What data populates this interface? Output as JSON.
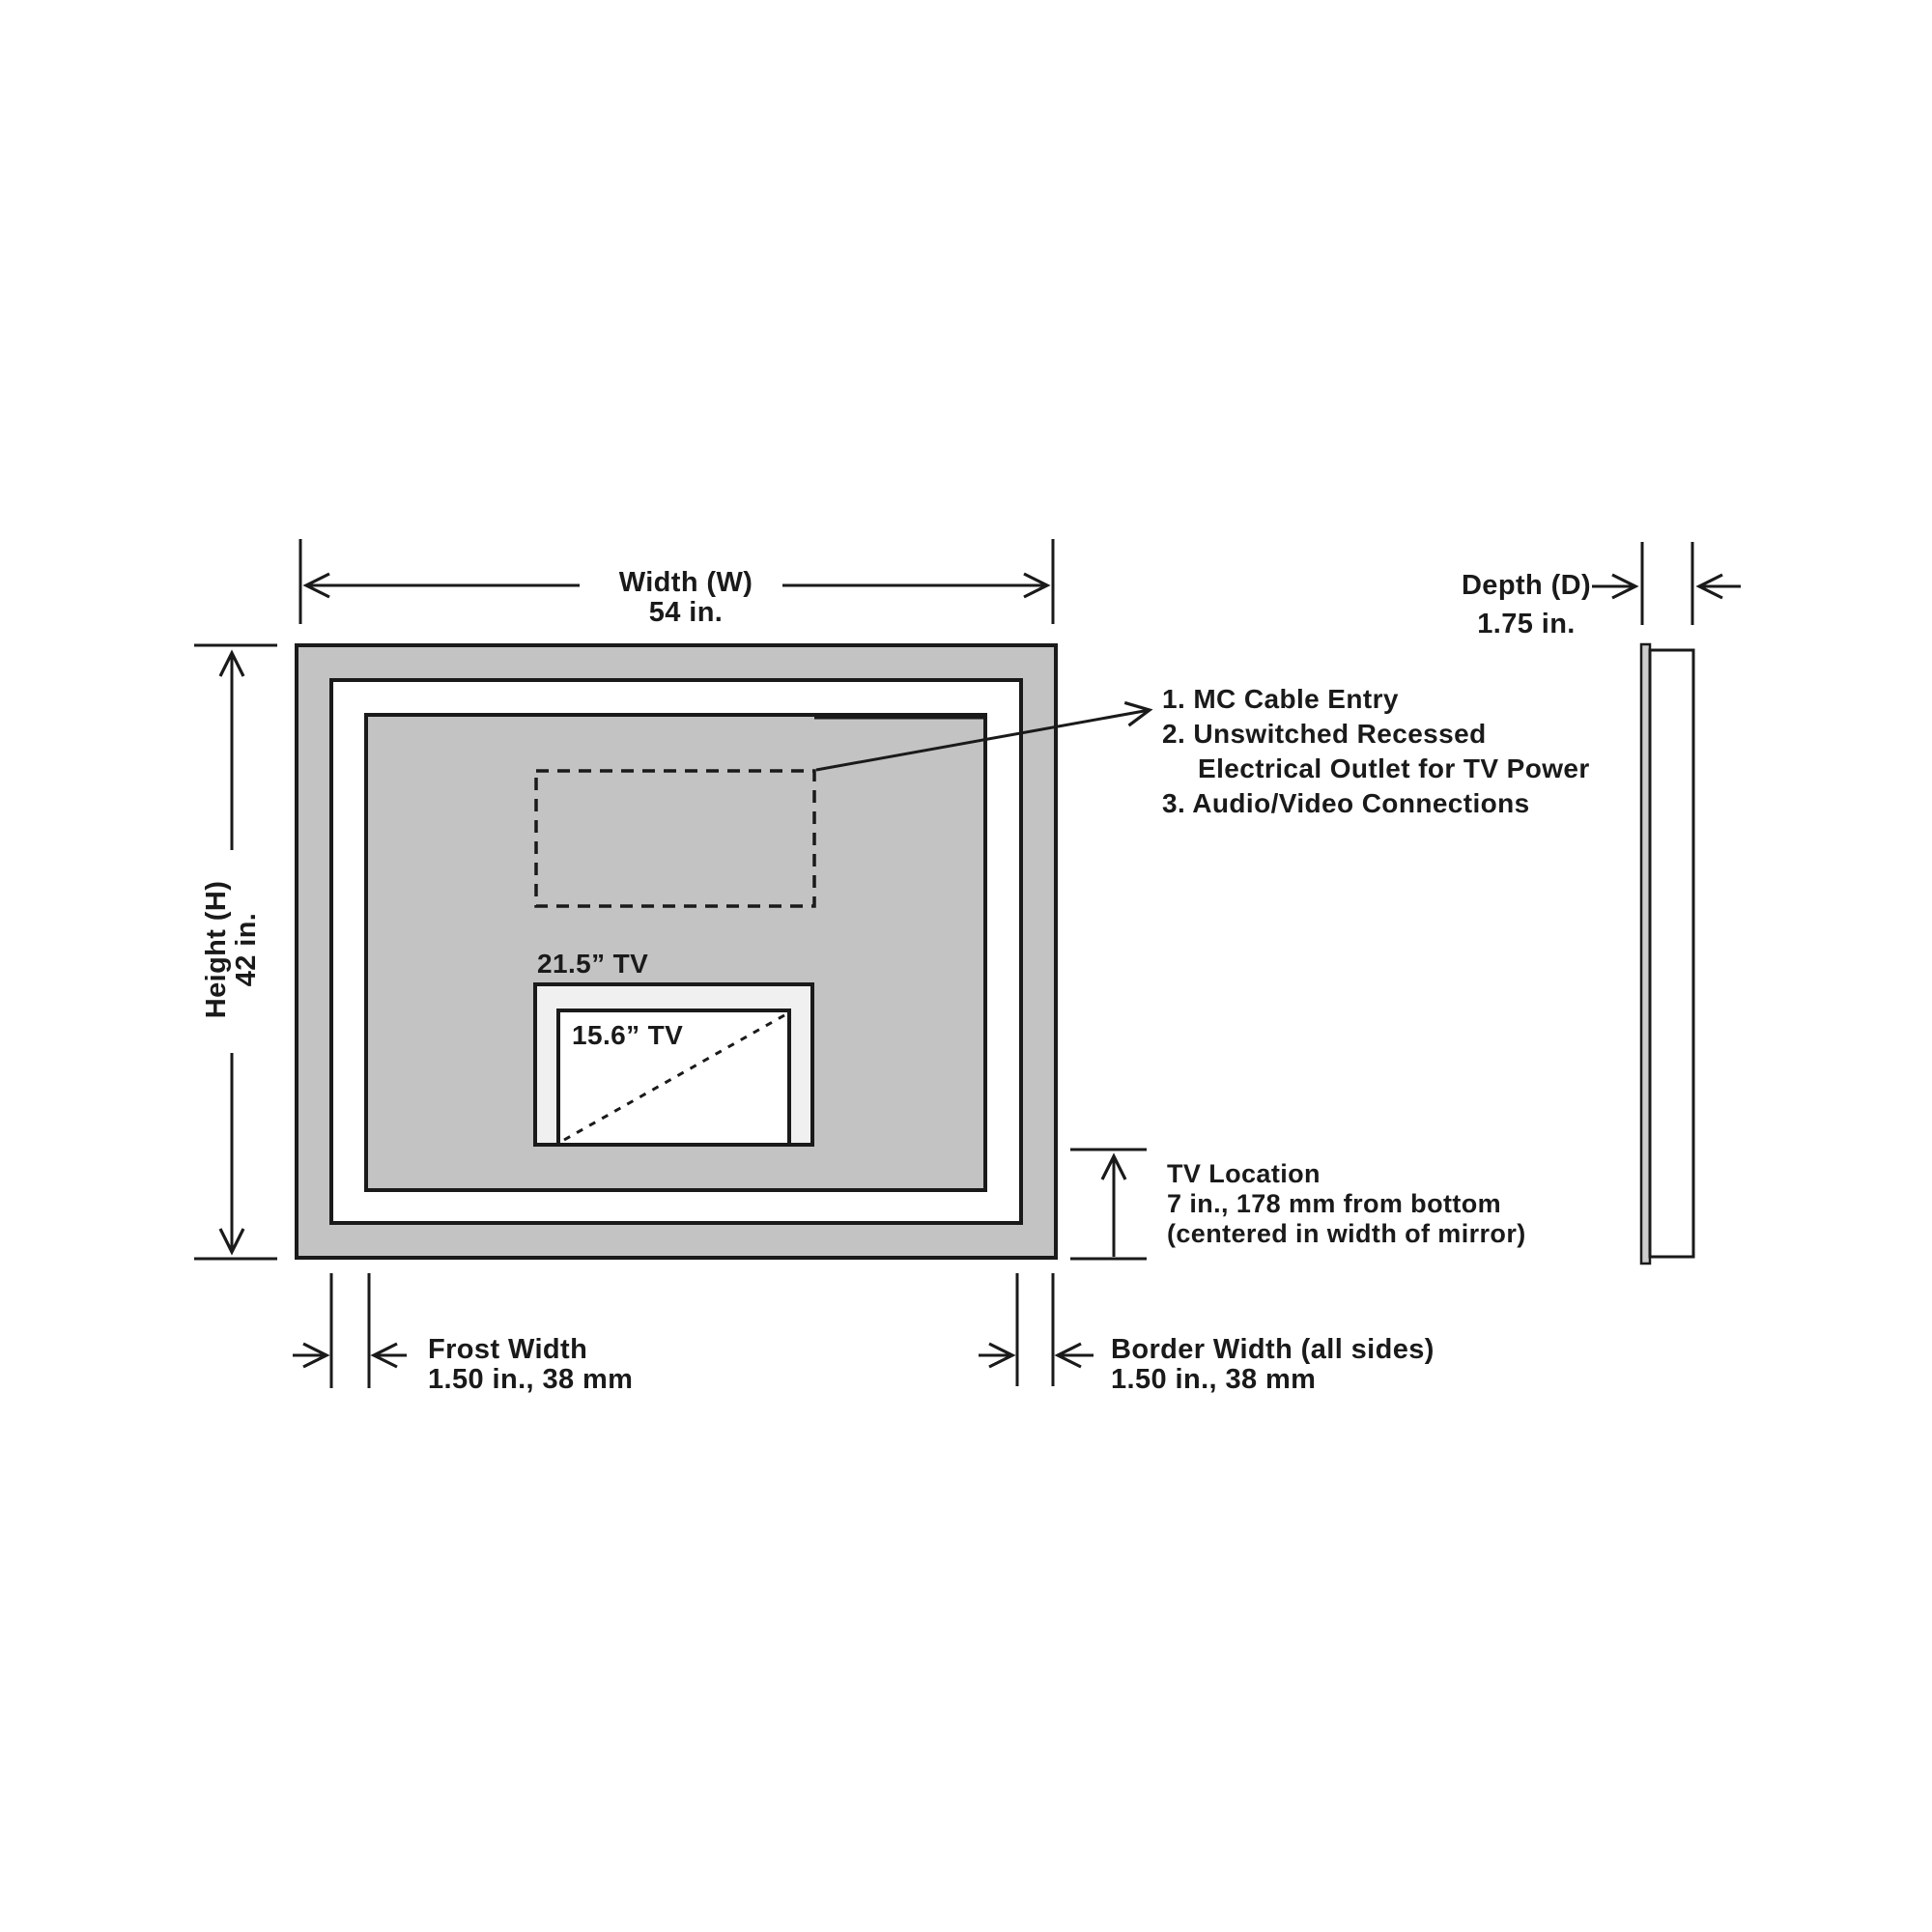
{
  "diagram": {
    "title_hint": "Mirror TV installation dimensions drawing",
    "front_view": {
      "width_label": "Width (W)",
      "width_value": "54 in.",
      "height_label": "Height (H)",
      "height_value": "42 in.",
      "tv_outer_label": "21.5” TV",
      "tv_inner_label": "15.6” TV"
    },
    "side_view": {
      "depth_label": "Depth (D)",
      "depth_value": "1.75 in."
    },
    "callout": [
      "1. MC Cable Entry",
      "2. Unswitched Recessed",
      "Electrical Outlet for TV Power",
      "3. Audio/Video Connections"
    ],
    "tv_location": {
      "line1": "TV Location",
      "line2": "7 in., 178 mm from bottom",
      "line3": "(centered in width of mirror)"
    },
    "frost": {
      "line1": "Frost Width",
      "line2": "1.50 in., 38 mm"
    },
    "border": {
      "line1": "Border Width (all sides)",
      "line2": "1.50 in., 38 mm"
    },
    "colors": {
      "line": "#1a1a1a",
      "mirror_gray": "#c3c3c3",
      "tv_surround": "#f0f0f0",
      "glass_gray": "#cccccc",
      "white": "#ffffff"
    }
  }
}
